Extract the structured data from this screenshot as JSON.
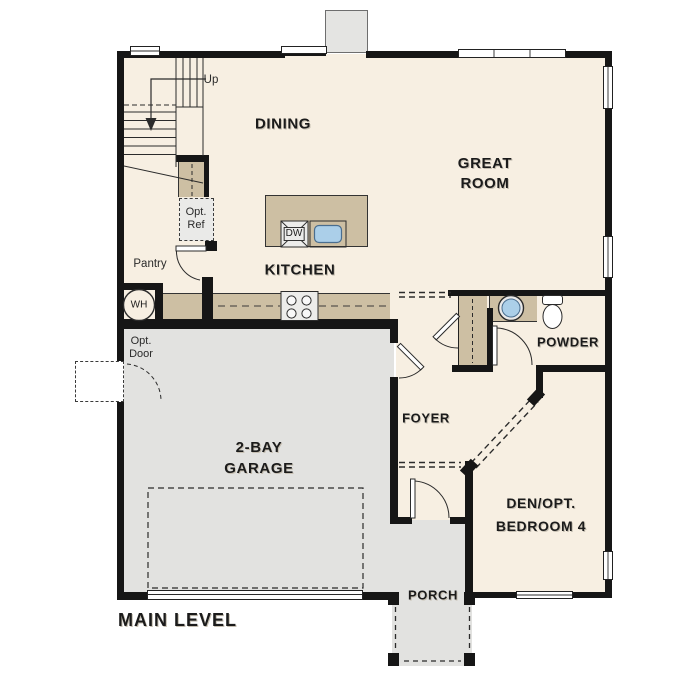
{
  "title": "MAIN LEVEL",
  "rooms": {
    "dining": "DINING",
    "great_room": {
      "line1": "GREAT",
      "line2": "ROOM"
    },
    "kitchen": "KITCHEN",
    "foyer": "FOYER",
    "powder": "POWDER",
    "den": {
      "line1": "DEN/OPT.",
      "line2": "BEDROOM 4"
    },
    "garage": {
      "line1": "2-BAY",
      "line2": "GARAGE"
    },
    "porch": "PORCH"
  },
  "annotations": {
    "stairs_direction": "Up",
    "pantry": "Pantry",
    "optional_refrigerator": {
      "line1": "Opt.",
      "line2": "Ref"
    },
    "optional_door": {
      "line1": "Opt.",
      "line2": "Door"
    },
    "water_heater": "WH",
    "dishwasher": "DW"
  },
  "colors": {
    "interior_floor": "#f7efe2",
    "garage_floor": "#e2e2e0",
    "cabinet_tan": "#cdbfa3",
    "sink_blue": "#abcfe9",
    "wall": "#161616"
  }
}
